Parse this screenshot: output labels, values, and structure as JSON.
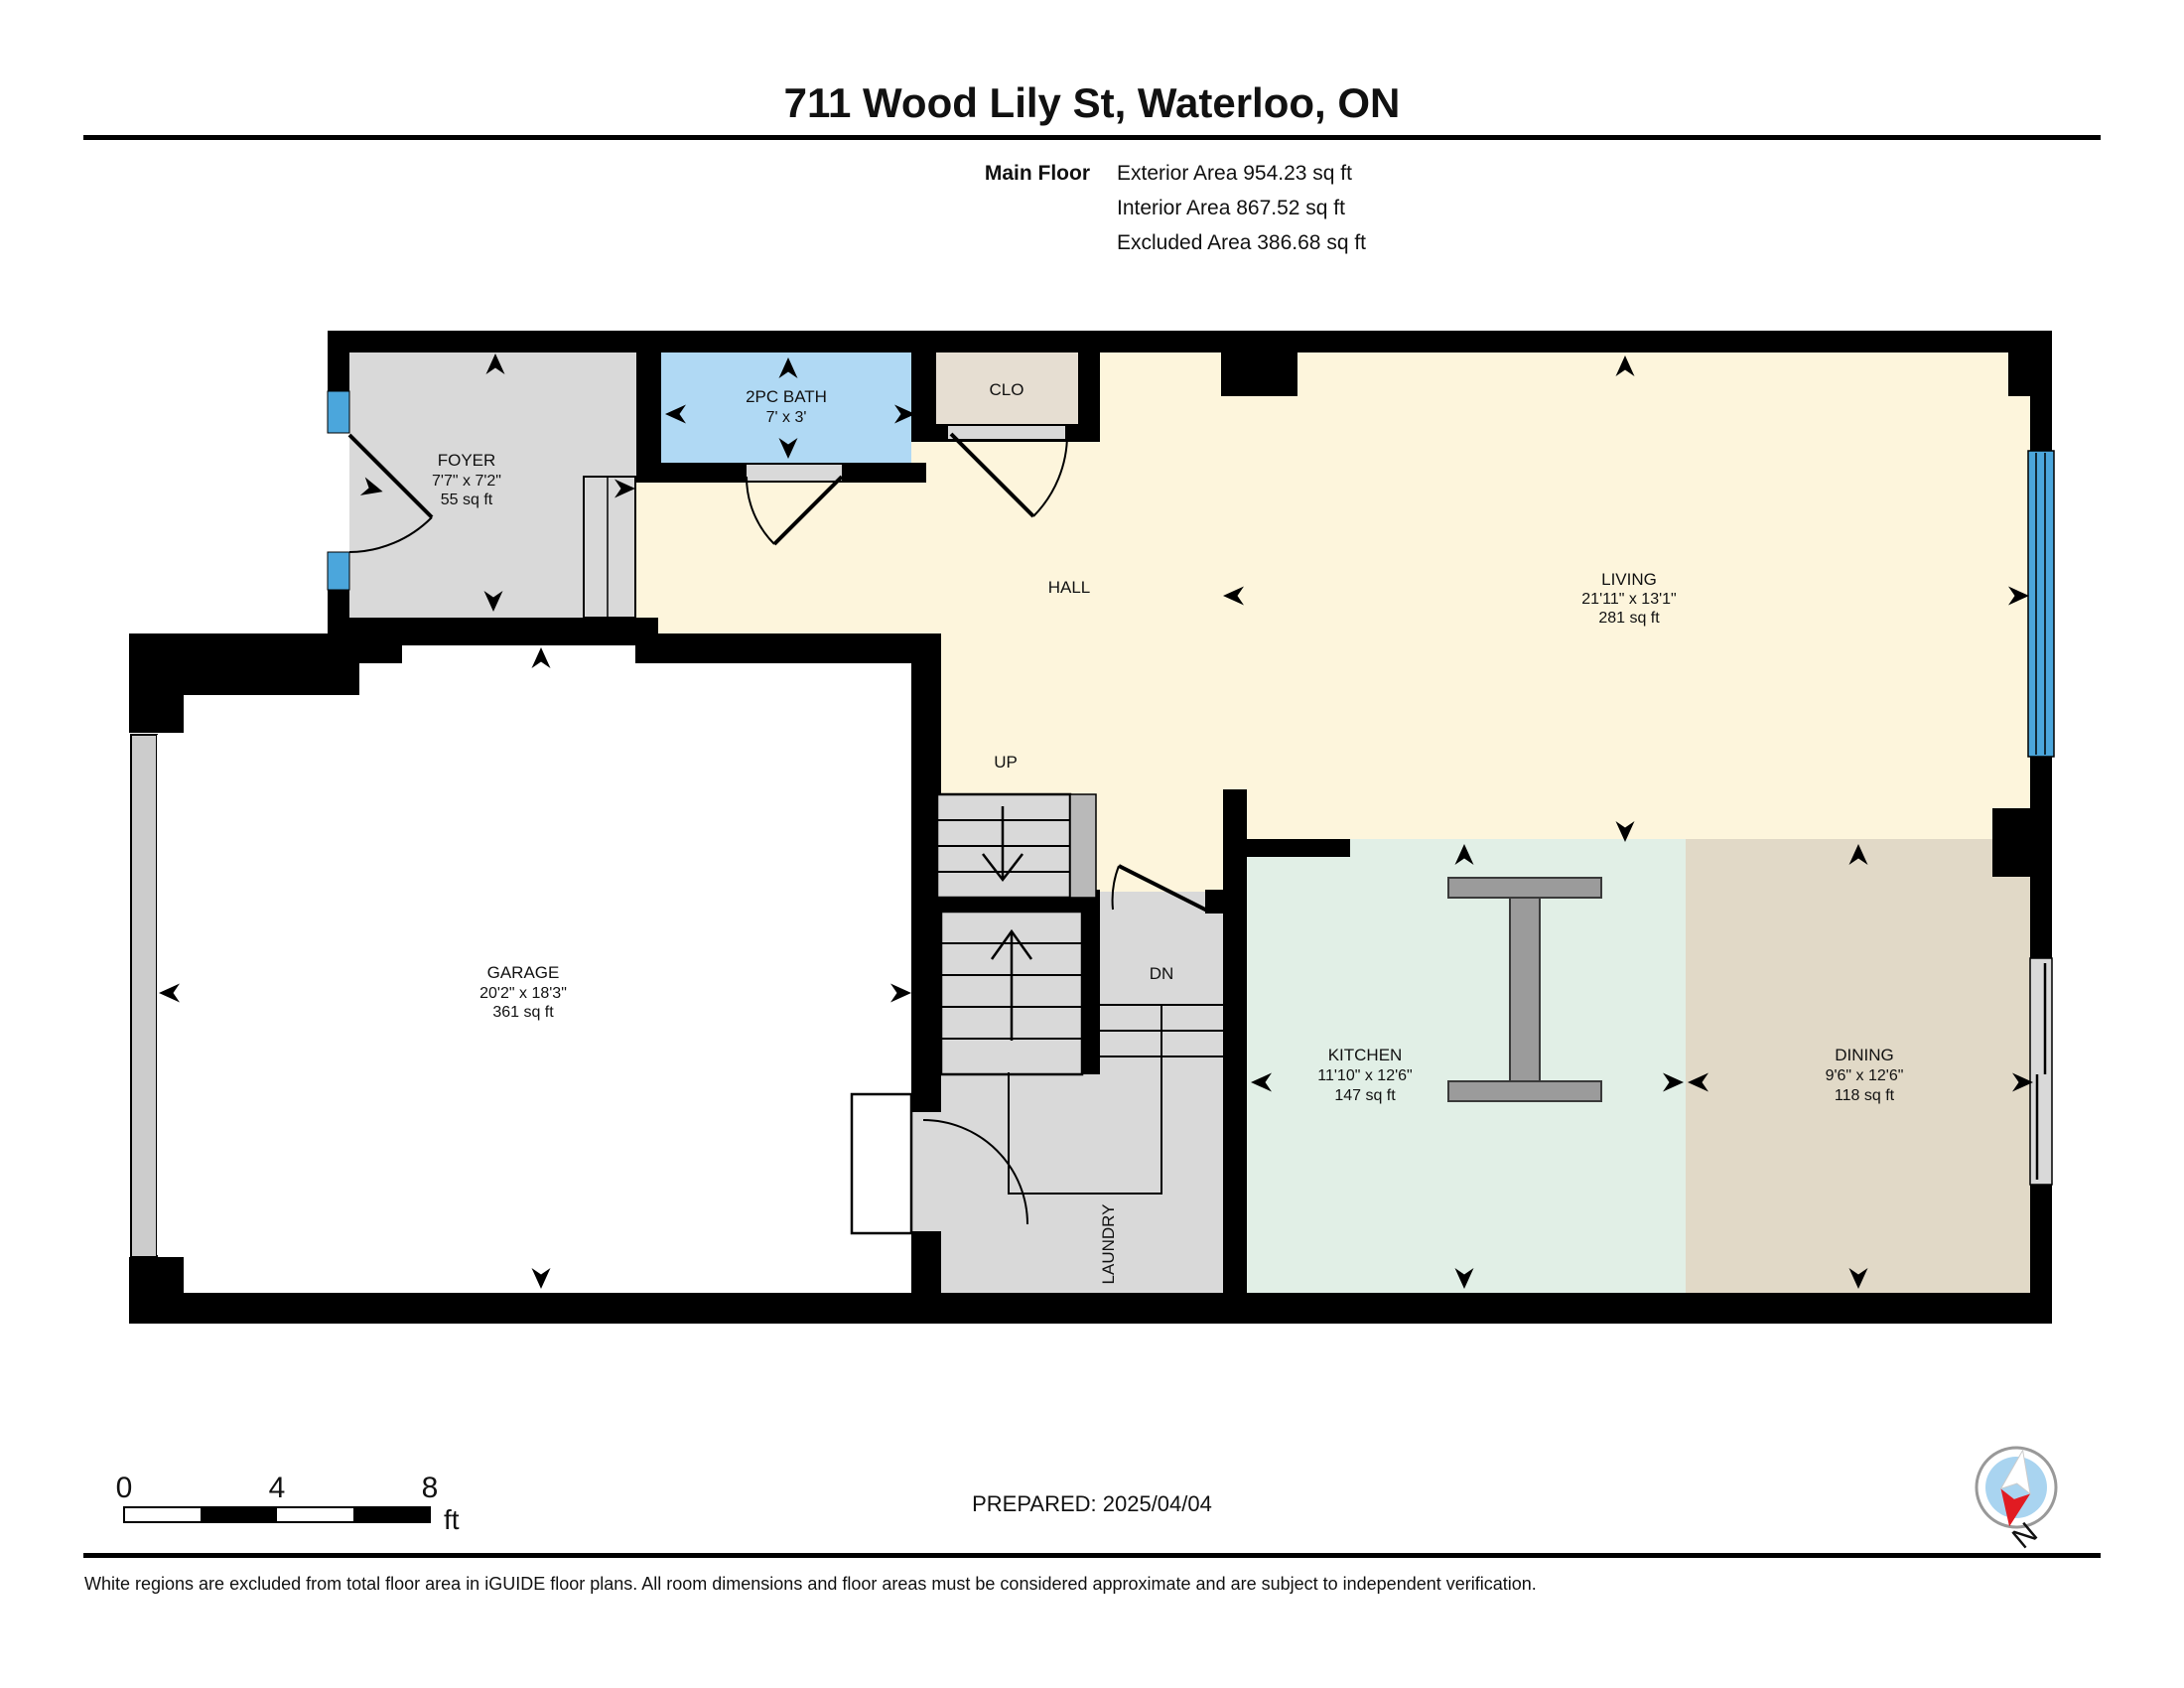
{
  "header": {
    "title": "711 Wood Lily St, Waterloo, ON",
    "floor_label": "Main Floor",
    "exterior_area": "Exterior Area 954.23 sq ft",
    "interior_area": "Interior Area 867.52 sq ft",
    "excluded_area": "Excluded Area 386.68 sq ft"
  },
  "rooms": {
    "foyer": {
      "name": "FOYER",
      "dims": "7'7\" x 7'2\"",
      "area": "55 sq ft"
    },
    "bath": {
      "name": "2PC BATH",
      "dims": "7' x 3'"
    },
    "closet": {
      "name": "CLO"
    },
    "hall": {
      "name": "HALL"
    },
    "living": {
      "name": "LIVING",
      "dims": "21'11\" x 13'1\"",
      "area": "281 sq ft"
    },
    "garage": {
      "name": "GARAGE",
      "dims": "20'2\" x 18'3\"",
      "area": "361 sq ft"
    },
    "kitchen": {
      "name": "KITCHEN",
      "dims": "11'10\" x 12'6\"",
      "area": "147 sq ft"
    },
    "dining": {
      "name": "DINING",
      "dims": "9'6\" x 12'6\"",
      "area": "118 sq ft"
    },
    "laundry": {
      "name": "LAUNDRY"
    }
  },
  "stairs": {
    "up_label": "UP",
    "down_label": "DN"
  },
  "scale_bar": {
    "ticks": [
      "0",
      "4",
      "8"
    ],
    "unit": "ft"
  },
  "footer": {
    "prepared": "PREPARED: 2025/04/04",
    "compass_label": "N",
    "disclaimer": "White regions are excluded from total floor area in iGUIDE floor plans. All room dimensions and floor areas must be considered approximate and are subject to independent verification."
  },
  "colors": {
    "wall": "#000000",
    "hall_living_floor": "#fdf5dc",
    "foyer_floor": "#d9d9d9",
    "bath_floor": "#b0d9f4",
    "closet_floor": "#e6ded2",
    "kitchen_floor": "#e1efe6",
    "dining_floor": "#e1d9c7",
    "garage_floor": "#ffffff",
    "window": "#4ba6dc",
    "island": "#9b9b9b",
    "compass_red": "#e11b22",
    "compass_blue": "#a9d4f0"
  }
}
